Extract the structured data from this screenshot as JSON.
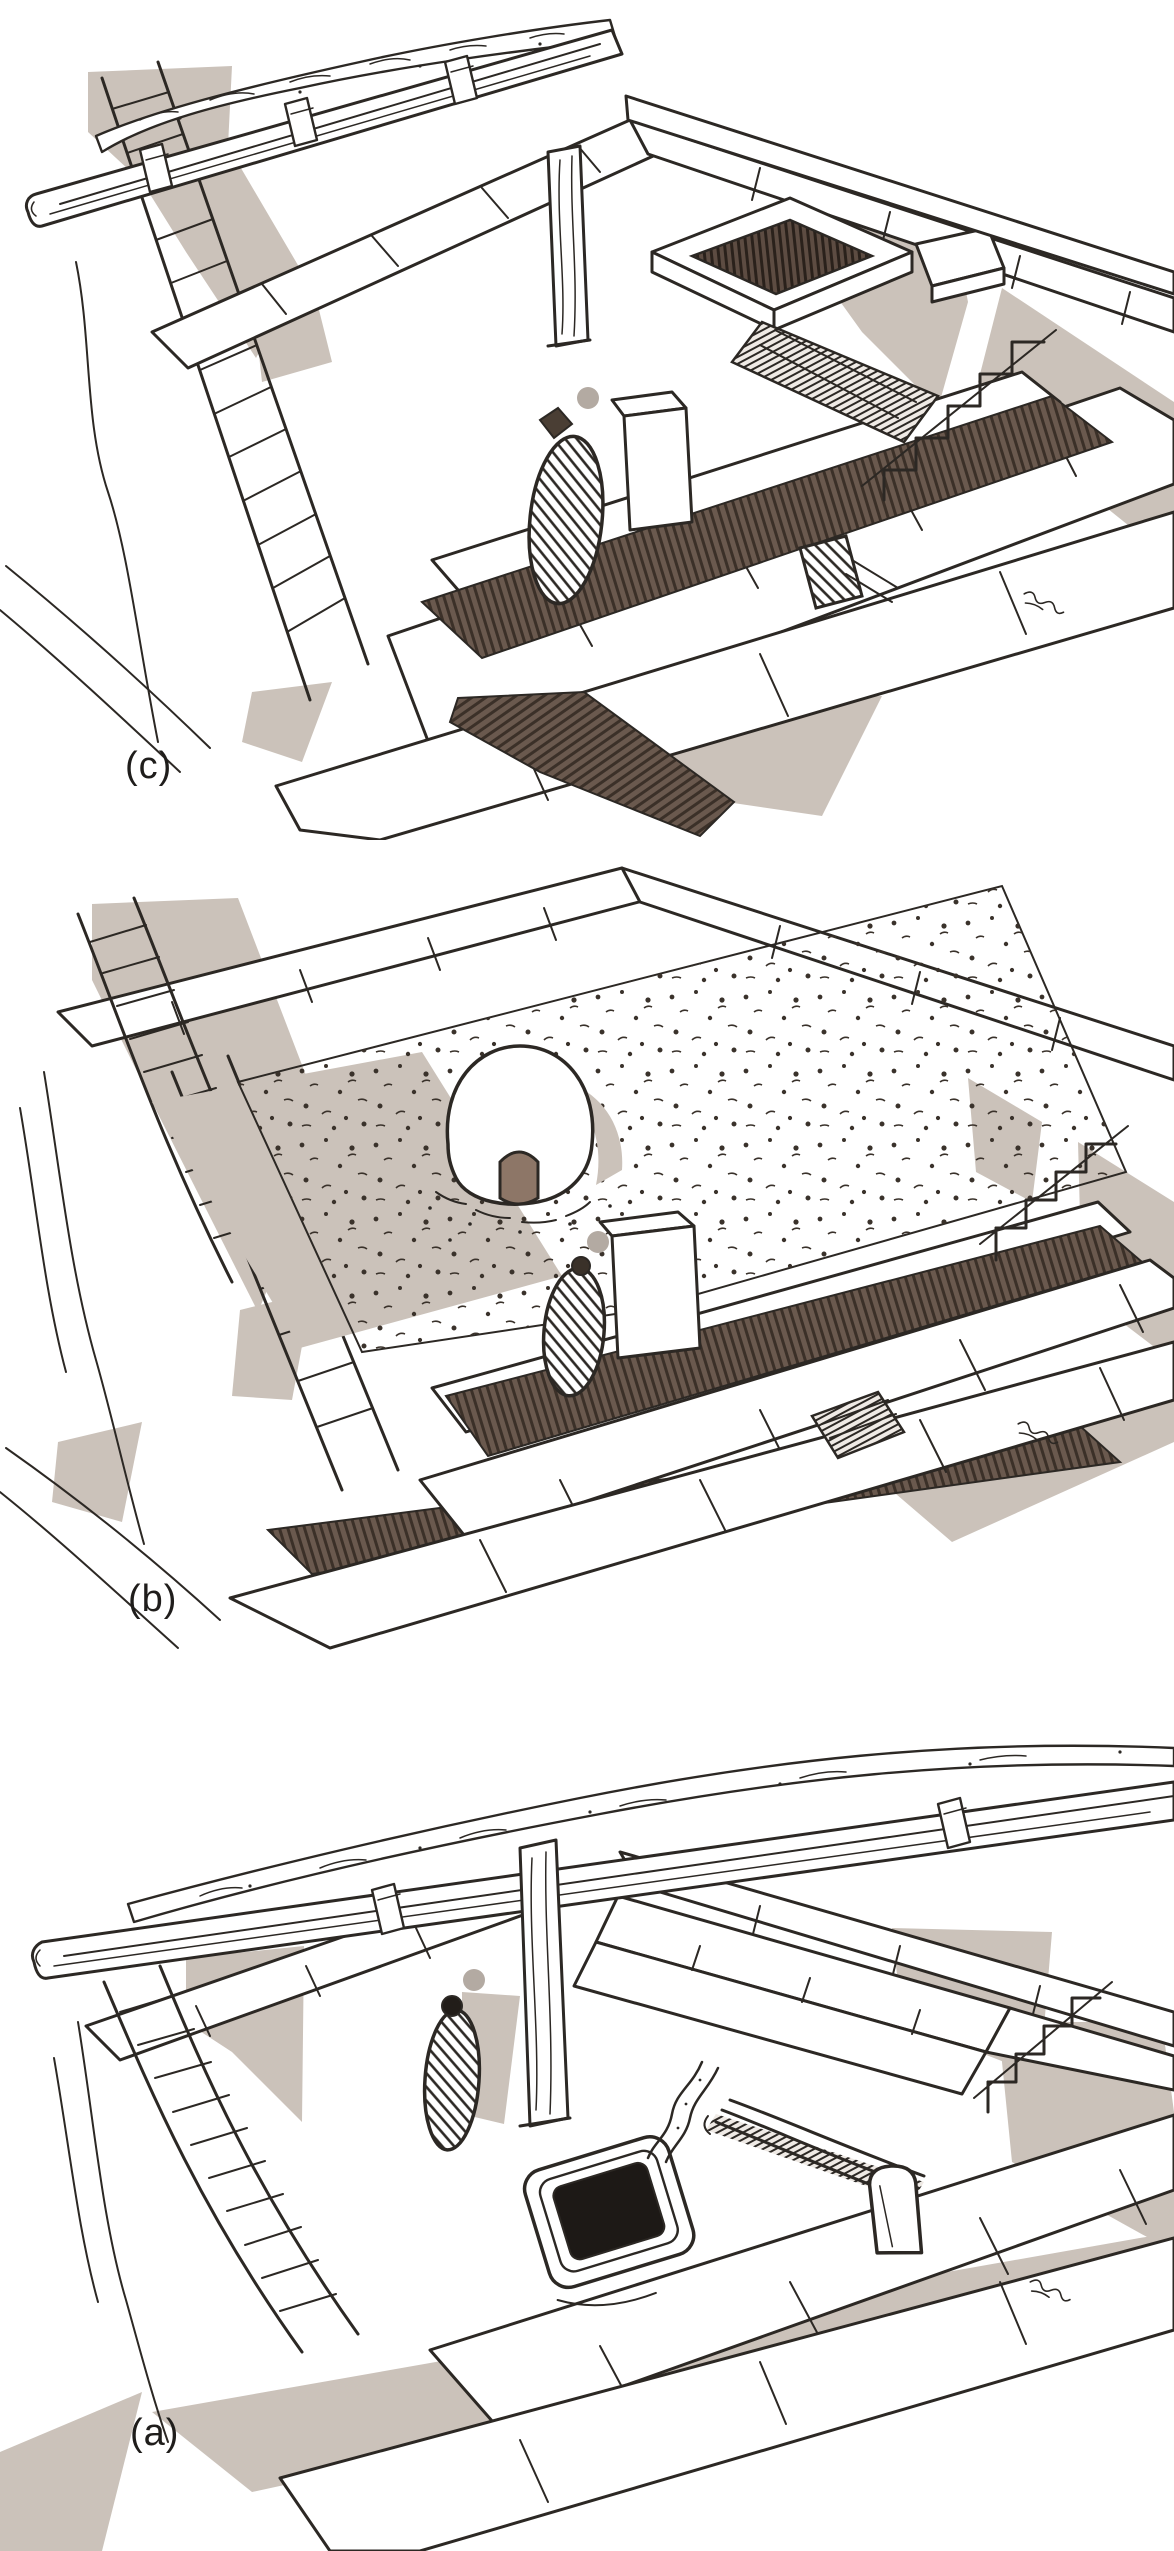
{
  "figure": {
    "panels": [
      {
        "id": "c",
        "label": "(c)",
        "depicts": [
          "timber-roof-beam-with-earth-cover",
          "walled-room",
          "hatched-pit-enclosure",
          "plank-covered-channel",
          "standing-stone",
          "dark-corridor-floor",
          "stepped-ashlar-walls"
        ]
      },
      {
        "id": "b",
        "label": "(b)",
        "depicts": [
          "earth-fill-stippled-surface",
          "domed-oven-with-dark-doorway",
          "standing-stone",
          "dark-corridor-floor",
          "wood-fragment",
          "stepped-ashlar-walls"
        ]
      },
      {
        "id": "a",
        "label": "(a)",
        "depicts": [
          "timber-roof-beam-with-earth-cover",
          "wooden-post",
          "standing-stone",
          "sunken-black-basin",
          "drain-channel",
          "leaning-planks",
          "stone-slab",
          "stepped-ashlar-walls"
        ]
      }
    ]
  },
  "colors": {
    "paper": "#ffffff",
    "ink": "#2c2824",
    "shadow_tan": "#cbc2ba",
    "floor_strip_brown": "#6a594e",
    "hatch_line_brown": "#3b3028",
    "gray_dot": "#b3aaa2",
    "oven_doorway_brown": "#8d7667",
    "basin_black": "#1d1916",
    "label_text": "#1f1d1b"
  }
}
